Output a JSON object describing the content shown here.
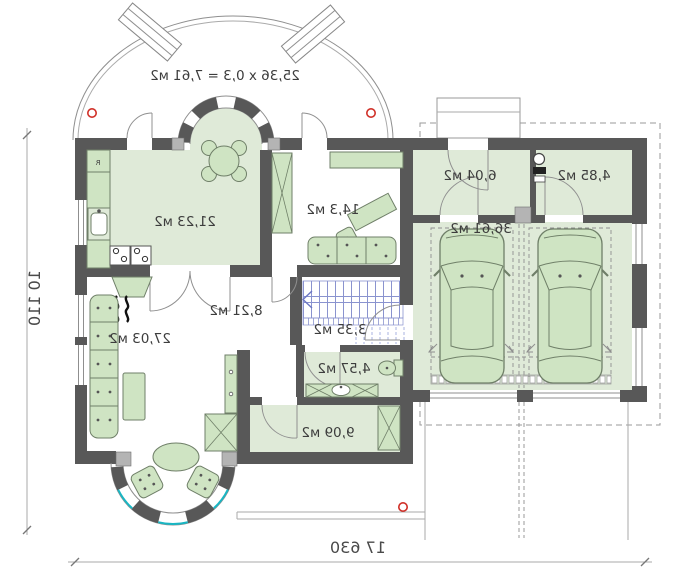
{
  "plan": {
    "terrace_label": "25,36 x 0,3 = 7,61 м2",
    "dimensions": {
      "horizontal": "17 630",
      "vertical": "10 110"
    },
    "rooms": {
      "kitchen": {
        "area": "21,23 м2"
      },
      "office": {
        "area": "14,3 м2"
      },
      "living": {
        "area": "27,03 м2"
      },
      "hall": {
        "area": "8,21 м2"
      },
      "stair_hall": {
        "area": "3,35 м2"
      },
      "bathroom": {
        "area": "4,57 м2"
      },
      "utility": {
        "area": "9,09 м2"
      },
      "vestibule": {
        "area": "6,04 м2"
      },
      "wc": {
        "area": "4,85 м2"
      },
      "garage": {
        "area": "36,61 м2"
      }
    },
    "kitchen_fridge_label": "R",
    "colors": {
      "wall": "#585858",
      "room_fill": "#dfead8",
      "furniture_fill": "#cfe4c3",
      "window_glass": "#19b6c3",
      "stairs": "#8a93cf",
      "survey_marker": "#d03028"
    }
  }
}
